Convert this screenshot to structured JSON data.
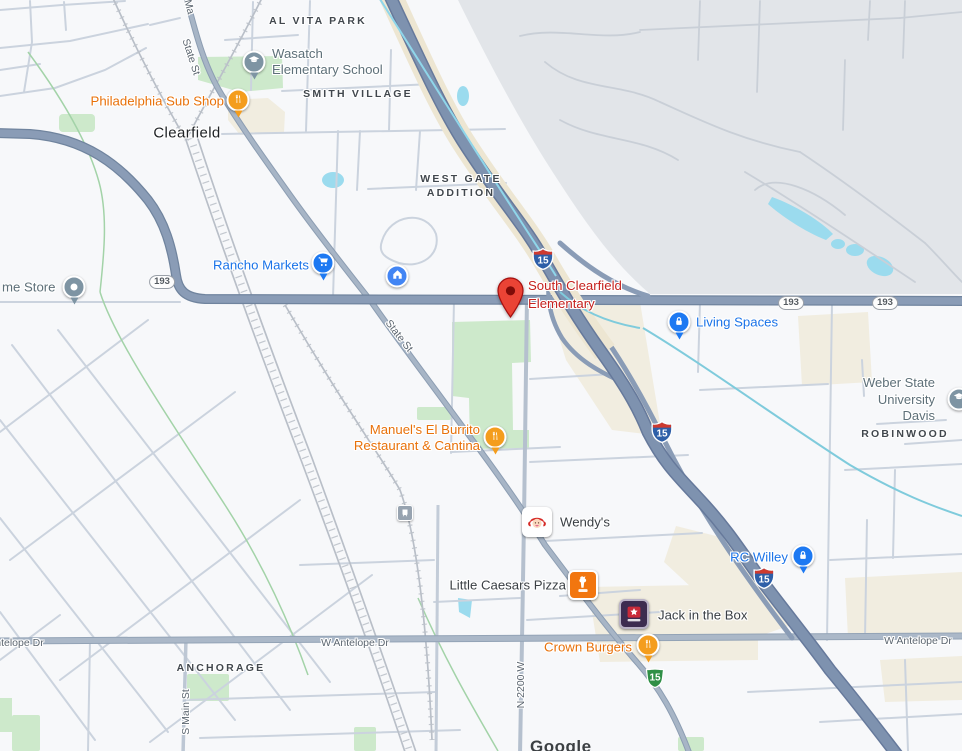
{
  "city": {
    "name": "Clearfield"
  },
  "areas": {
    "al_vita_park": "AL VITA PARK",
    "smith_village": "SMITH VILLAGE",
    "west_gate_line1": "WEST GATE",
    "west_gate_line2": "ADDITION",
    "anchorage": "ANCHORAGE",
    "robinwood": "ROBINWOOD"
  },
  "roads": {
    "state_st": "State St",
    "main_st_partial": "Ma",
    "s_main_st": "S Main St",
    "n_2200_w": "N 2200 W",
    "w_antelope_dr": "W Antelope Dr"
  },
  "shields": {
    "interstate": "15",
    "route_193": "193",
    "business_15": "15"
  },
  "pois": {
    "wasatch_elementary": {
      "line1": "Wasatch",
      "line2": "Elementary School",
      "icon": "graduation-cap"
    },
    "philadelphia_sub_shop": {
      "label": "Philadelphia Sub Shop",
      "icon": "fork-knife"
    },
    "home_store_partial": {
      "label": "me Store",
      "icon": "dot"
    },
    "rancho_markets": {
      "label": "Rancho Markets",
      "icon": "shopping-cart"
    },
    "home_improvement": {
      "icon": "house"
    },
    "south_clearfield_elementary": {
      "line1": "South Clearfield",
      "line2": "Elementary",
      "icon": "red-pin"
    },
    "living_spaces": {
      "label": "Living Spaces",
      "icon": "lock"
    },
    "weber_state": {
      "line1": "Weber State",
      "line2": "University",
      "line3": "Davis",
      "icon": "graduation-cap"
    },
    "manuels": {
      "line1": "Manuel's El Burrito",
      "line2": "Restaurant & Cantina",
      "icon": "fork-knife"
    },
    "wendys": {
      "label": "Wendy's",
      "icon": "wendys-logo"
    },
    "train_station": {
      "icon": "train"
    },
    "little_caesars": {
      "label": "Little Caesars Pizza",
      "icon": "little-caesars-logo"
    },
    "jack_in_the_box": {
      "label": "Jack in the Box",
      "icon": "jack-in-the-box-logo"
    },
    "crown_burgers": {
      "label": "Crown Burgers",
      "icon": "fork-knife"
    },
    "rc_willey": {
      "label": "RC Willey",
      "icon": "lock"
    }
  },
  "attribution": {
    "text": "Google"
  },
  "colors": {
    "destination_red": "#C5221F",
    "pin_red": "#EA4335",
    "poi_orange": "#E8710A",
    "poi_blue": "#1A73E8",
    "poi_gray": "#5E7079",
    "area_label": "#41474D",
    "freeway": "#7E92AF",
    "highway": "#8A9CB6",
    "water": "#9BDBEE",
    "park_green": "#CDE9CB",
    "military_gray": "#E2E5E9",
    "commercial_beige": "#F1EDE0",
    "background": "#F7F8FA"
  }
}
